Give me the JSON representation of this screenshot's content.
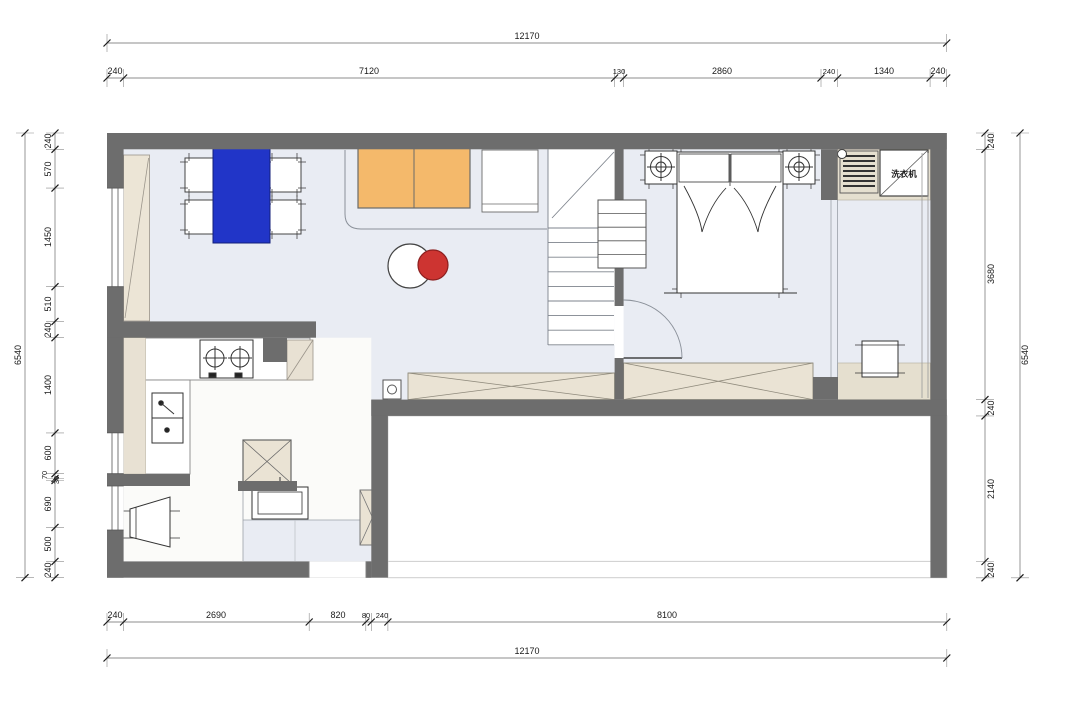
{
  "labels": {
    "washing_machine": "洗衣机"
  },
  "dimensions": {
    "top_total": "12170",
    "top_segments": [
      "240",
      "7120",
      "130",
      "2860",
      "240",
      "1340",
      "240"
    ],
    "bottom_segments": [
      "240",
      "2690",
      "820",
      "80",
      "240",
      "8100"
    ],
    "bottom_total": "12170",
    "left_total": "6540",
    "left_segments": [
      "240",
      "570",
      "1450",
      "510",
      "240",
      "1400",
      "600",
      "70",
      "30",
      "690",
      "500",
      "240"
    ],
    "right_segments": [
      "240",
      "3680",
      "240",
      "2140",
      "240"
    ],
    "right_total": "6540"
  },
  "colors": {
    "wall": "#6d6d6d",
    "floor": "#e9ecf3",
    "beige": "#e8e1d3",
    "table_blue": "#2135c8",
    "sofa_orange": "#f4b96b",
    "accent_red": "#cd3431"
  }
}
